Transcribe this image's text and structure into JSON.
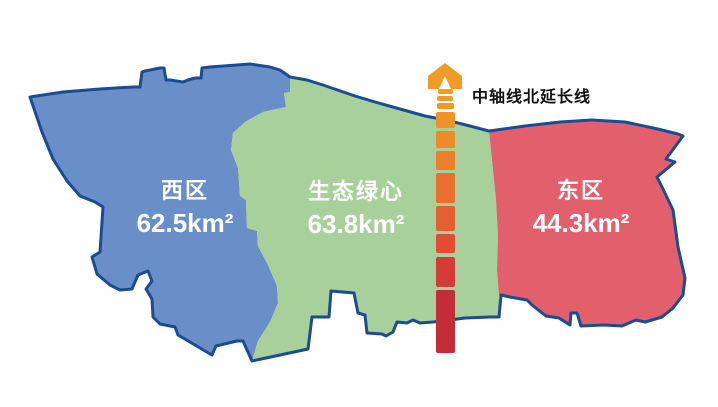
{
  "map": {
    "border_color": "#1A4C94",
    "background": "#FFFFFF"
  },
  "regions": [
    {
      "name": "西区",
      "area_label": "62.5km²",
      "fill": "#6A8EC8"
    },
    {
      "name": "生态绿心",
      "area_label": "63.8km²",
      "fill": "#A7D09B"
    },
    {
      "name": "东区",
      "area_label": "44.3km²",
      "fill": "#E2606C"
    }
  ],
  "axis": {
    "label": "中轴线北延长线",
    "arrow_color": "#F09B26",
    "center_x": 445,
    "segments": [
      {
        "top": 89,
        "h": 5,
        "w": 15,
        "color": "#F29C26"
      },
      {
        "top": 96,
        "h": 5,
        "w": 16,
        "color": "#F29A26"
      },
      {
        "top": 103,
        "h": 6,
        "w": 17,
        "color": "#F19727"
      },
      {
        "top": 112,
        "h": 16,
        "w": 19,
        "color": "#F09228"
      },
      {
        "top": 131,
        "h": 17,
        "w": 19,
        "color": "#EF8A29"
      },
      {
        "top": 151,
        "h": 19,
        "w": 19,
        "color": "#ED7F2A"
      },
      {
        "top": 173,
        "h": 30,
        "w": 19,
        "color": "#EA6F2D"
      },
      {
        "top": 206,
        "h": 25,
        "w": 19,
        "color": "#E65F31"
      },
      {
        "top": 234,
        "h": 19,
        "w": 19,
        "color": "#E04C34"
      },
      {
        "top": 257,
        "h": 30,
        "w": 19,
        "color": "#D63C37"
      },
      {
        "top": 290,
        "h": 63,
        "w": 19,
        "color": "#C22D38"
      }
    ]
  }
}
